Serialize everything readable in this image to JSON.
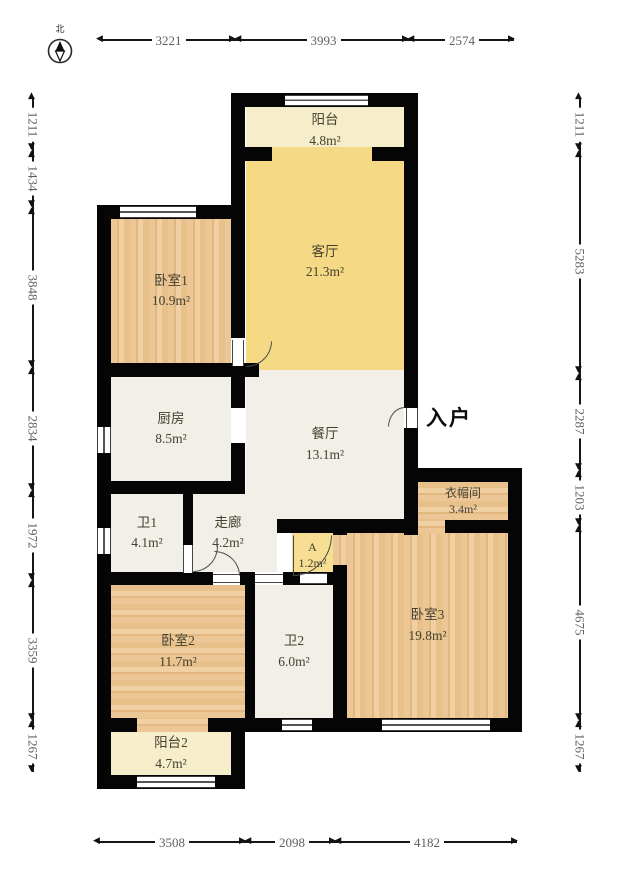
{
  "title": "户型图 (apartment floor plan)",
  "compass": {
    "north_label": "北"
  },
  "entrance": {
    "label": "入户"
  },
  "rooms": [
    {
      "id": "balcony1",
      "name": "阳台",
      "area": "4.8m²"
    },
    {
      "id": "living",
      "name": "客厅",
      "area": "21.3m²"
    },
    {
      "id": "bedroom1",
      "name": "卧室1",
      "area": "10.9m²"
    },
    {
      "id": "kitchen",
      "name": "厨房",
      "area": "8.5m²"
    },
    {
      "id": "dining",
      "name": "餐厅",
      "area": "13.1m²"
    },
    {
      "id": "bath1",
      "name": "卫1",
      "area": "4.1m²"
    },
    {
      "id": "corridor",
      "name": "走廊",
      "area": "4.2m²"
    },
    {
      "id": "closet-a",
      "name": "A",
      "area": "1.2m²"
    },
    {
      "id": "cloakroom",
      "name": "衣帽间",
      "area": "3.4m²"
    },
    {
      "id": "bedroom2",
      "name": "卧室2",
      "area": "11.7m²"
    },
    {
      "id": "bath2",
      "name": "卫2",
      "area": "6.0m²"
    },
    {
      "id": "bedroom3",
      "name": "卧室3",
      "area": "19.8m²"
    },
    {
      "id": "balcony2",
      "name": "阳台2",
      "area": "4.7m²"
    }
  ],
  "dimensions": {
    "top": [
      "3221",
      "3993",
      "2574"
    ],
    "bottom": [
      "3508",
      "2098",
      "4182"
    ],
    "left": [
      "1211",
      "1434",
      "3848",
      "2834",
      "1972",
      "3359",
      "1267"
    ],
    "right": [
      "1211",
      "5283",
      "2287",
      "1203",
      "4675",
      "1267"
    ]
  },
  "colors": {
    "wall": "#050505",
    "living_yellow": "#f5d985",
    "closet_yellow": "#f6df92",
    "balcony_cream": "#f6eecb",
    "wood": "#e8c18a",
    "white_room": "#f1efe8",
    "dimension_text": "#5f5f5f",
    "room_text": "#45402f"
  }
}
